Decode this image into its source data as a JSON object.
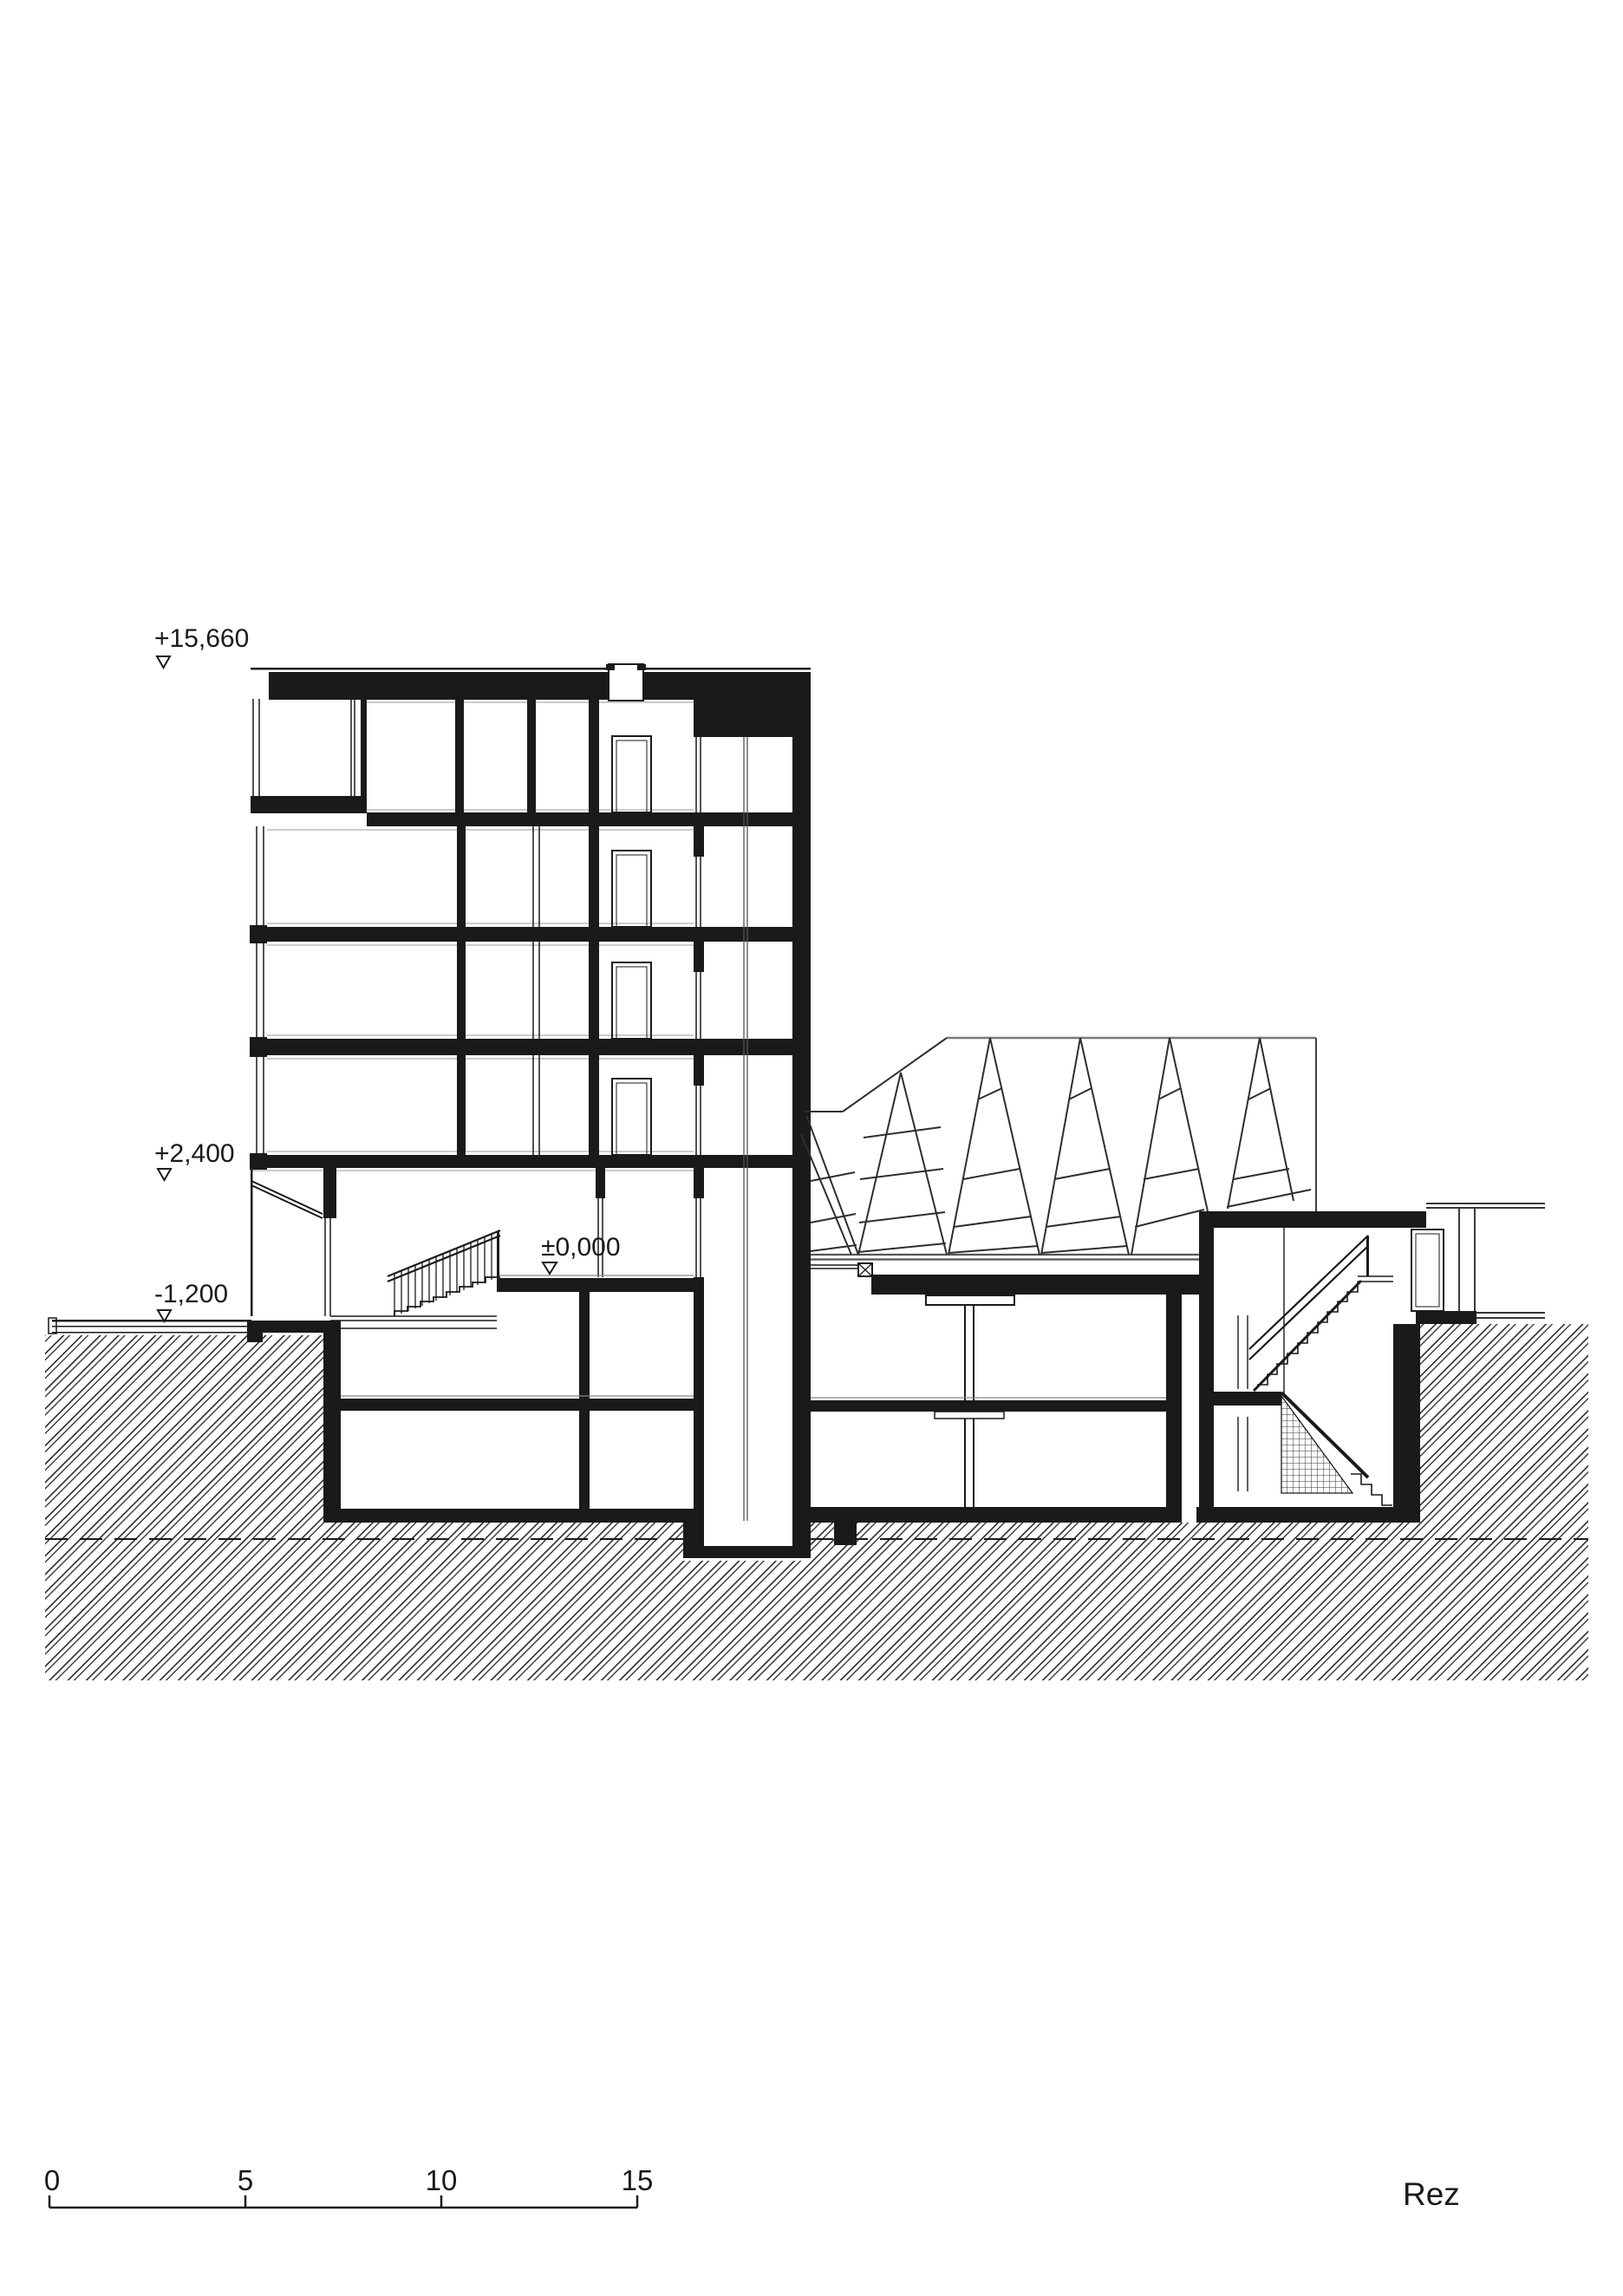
{
  "drawing": {
    "title": "Rez",
    "type_note": "architectural building section",
    "colors": {
      "background": "#ffffff",
      "ink": "#1a1a1a",
      "truss_line": "#2e2e2e",
      "light_line": "#8a8a8a"
    }
  },
  "elevation_markers": {
    "roof": {
      "label": "+15,660"
    },
    "first_floor": {
      "label": "+2,400"
    },
    "ground_floor": {
      "label": "±0,000"
    },
    "street": {
      "label": "-1,200"
    }
  },
  "scale_bar": {
    "unit_labels": [
      "0",
      "5",
      "10",
      "15"
    ]
  }
}
